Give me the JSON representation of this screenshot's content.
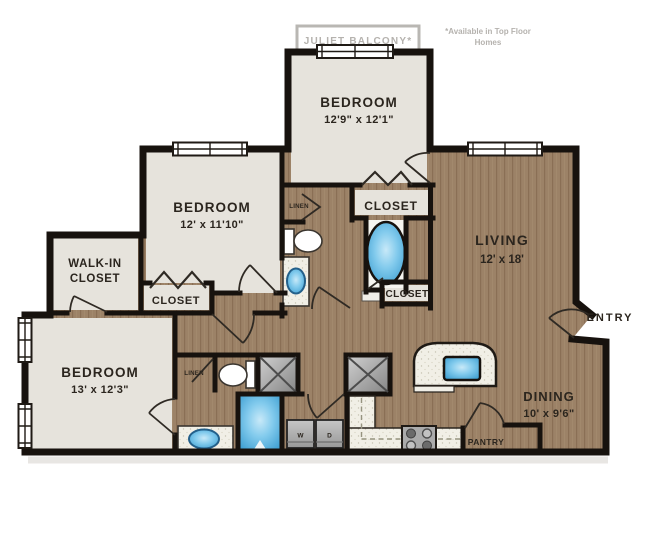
{
  "balcony": {
    "label": "JULIET BALCONY*"
  },
  "note": {
    "line1": "*Available in Top Floor",
    "line2": "Homes"
  },
  "rooms": {
    "bedroom_top": {
      "name": "BEDROOM",
      "dims": "12'9\" x 12'1\""
    },
    "bedroom_mid": {
      "name": "BEDROOM",
      "dims": "12' x 11'10\""
    },
    "bedroom_bottom": {
      "name": "BEDROOM",
      "dims": "13' x 12'3\""
    },
    "living": {
      "name": "LIVING",
      "dims": "12' x 18'"
    },
    "dining": {
      "name": "DINING",
      "dims": "10' x 9'6\""
    },
    "walk_in_closet": {
      "line1": "WALK-IN",
      "line2": "CLOSET"
    }
  },
  "labels": {
    "closet_upper": "CLOSET",
    "closet_mid": "CLOSET",
    "closet_bedroom_mid": "CLOSET",
    "linen_upper": "LINEN",
    "linen_lower": "LINEN",
    "entry": "ENTRY",
    "pantry": "PANTRY",
    "washer": "W",
    "dryer": "D"
  },
  "colors": {
    "wall": "#17120e",
    "wood": "#9c8267",
    "carpet": "#e6e3dc",
    "counter": "#f1efe6",
    "fixture_blue": "#56b6e4",
    "note_gray": "#b5b2ae"
  }
}
